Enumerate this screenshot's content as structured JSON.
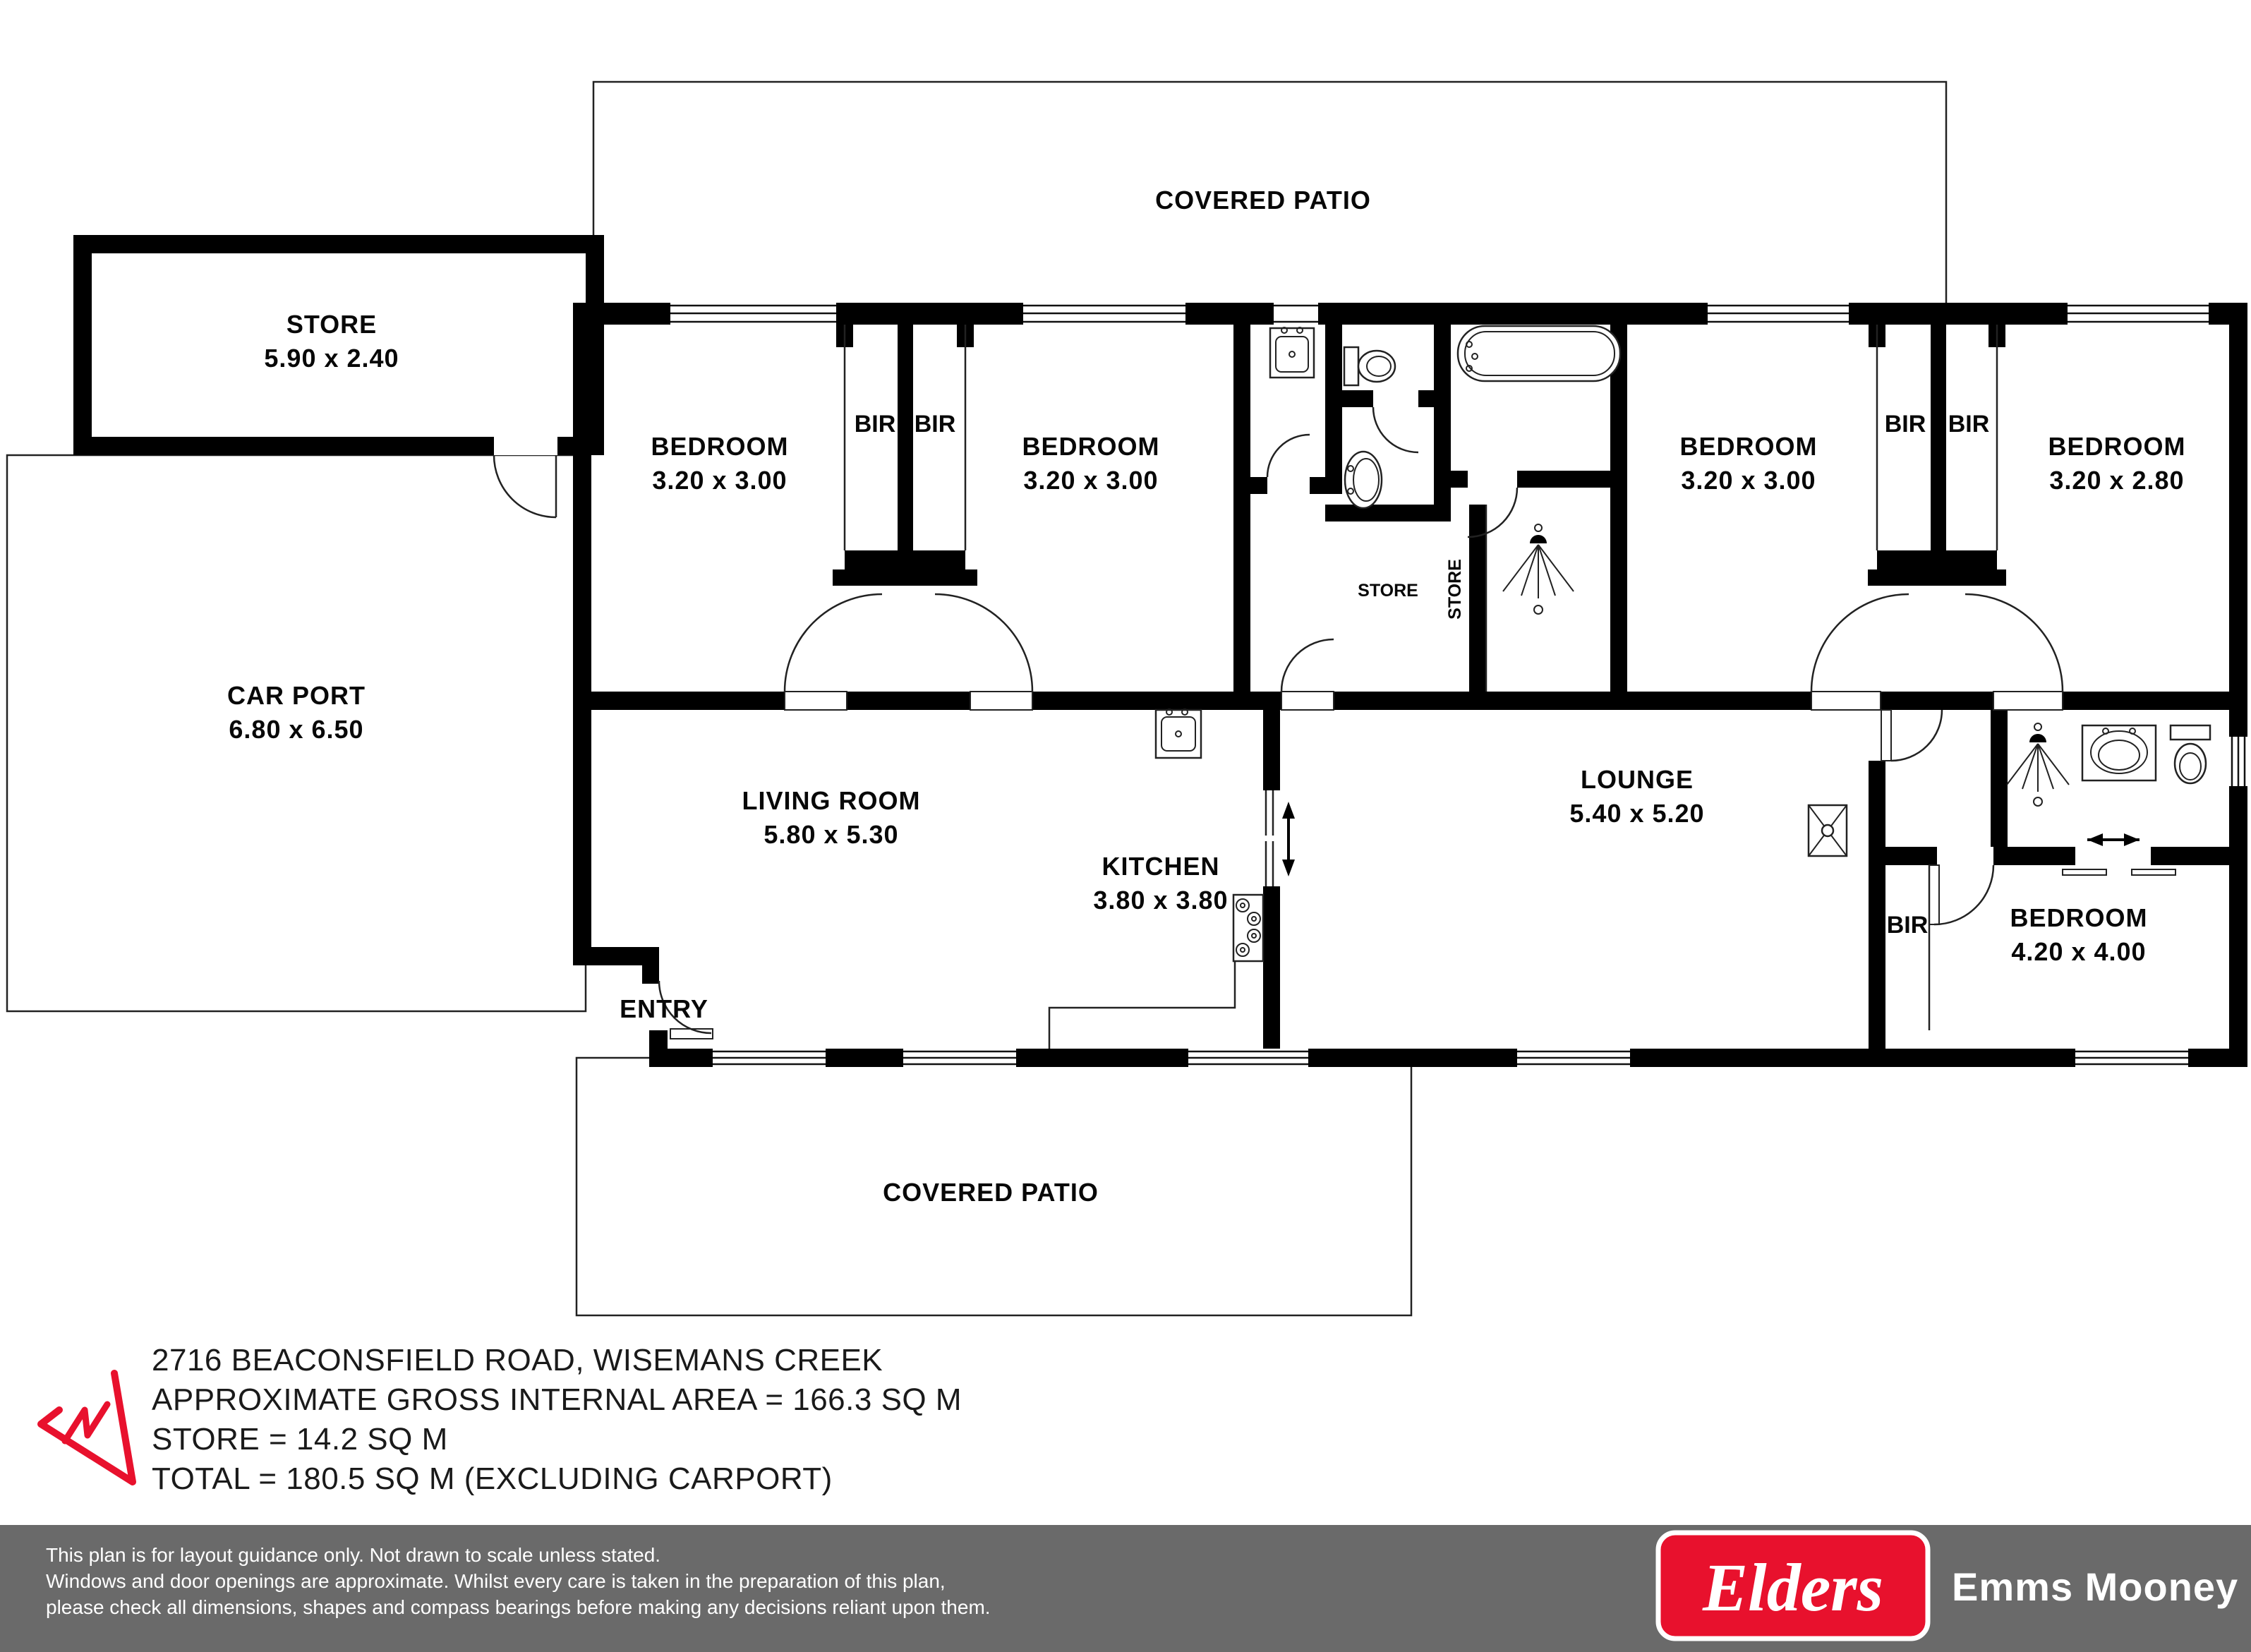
{
  "rooms": {
    "patio_top": {
      "label": "COVERED PATIO"
    },
    "store_building": {
      "label": "STORE",
      "dims": "5.90 x 2.40"
    },
    "carport": {
      "label": "CAR PORT",
      "dims": "6.80 x 6.50"
    },
    "bedroom1": {
      "label": "BEDROOM",
      "dims": "3.20 x 3.00"
    },
    "bedroom2": {
      "label": "BEDROOM",
      "dims": "3.20 x 3.00"
    },
    "bedroom3": {
      "label": "BEDROOM",
      "dims": "3.20 x 3.00"
    },
    "bedroom4": {
      "label": "BEDROOM",
      "dims": "3.20 x 2.80"
    },
    "master_bedroom": {
      "label": "BEDROOM",
      "dims": "4.20 x 4.00"
    },
    "living": {
      "label": "LIVING ROOM",
      "dims": "5.80 x 5.30"
    },
    "kitchen": {
      "label": "KITCHEN",
      "dims": "3.80 x 3.80"
    },
    "lounge": {
      "label": "LOUNGE",
      "dims": "5.40 x 5.20"
    },
    "entry": {
      "label": "ENTRY"
    },
    "patio_bottom": {
      "label": "COVERED PATIO"
    }
  },
  "closets": {
    "bir1": "BIR",
    "bir2": "BIR",
    "bir3": "BIR",
    "bir4": "BIR",
    "bir5": "BIR"
  },
  "stores": {
    "store1": "STORE",
    "store2": "STORE"
  },
  "summary": {
    "address": "2716 BEACONSFIELD ROAD, WISEMANS CREEK",
    "gross_internal": "APPROXIMATE GROSS INTERNAL AREA = 166.3 SQ M",
    "store_area": "STORE = 14.2 SQ M",
    "total_area": "TOTAL = 180.5 SQ M (EXCLUDING CARPORT)"
  },
  "footer": {
    "disclaimer_line1": "This plan is for layout guidance only. Not drawn to scale unless stated.",
    "disclaimer_line2": "Windows and door openings are approximate. Whilst every care is taken in the preparation of this plan,",
    "disclaimer_line3": "please check all dimensions, shapes and compass bearings before making any decisions reliant upon them.",
    "brand": "Elders",
    "agency": "Emms Mooney"
  },
  "colors": {
    "brand_red": "#e8112d",
    "footer_gray": "#6a6a6a"
  }
}
